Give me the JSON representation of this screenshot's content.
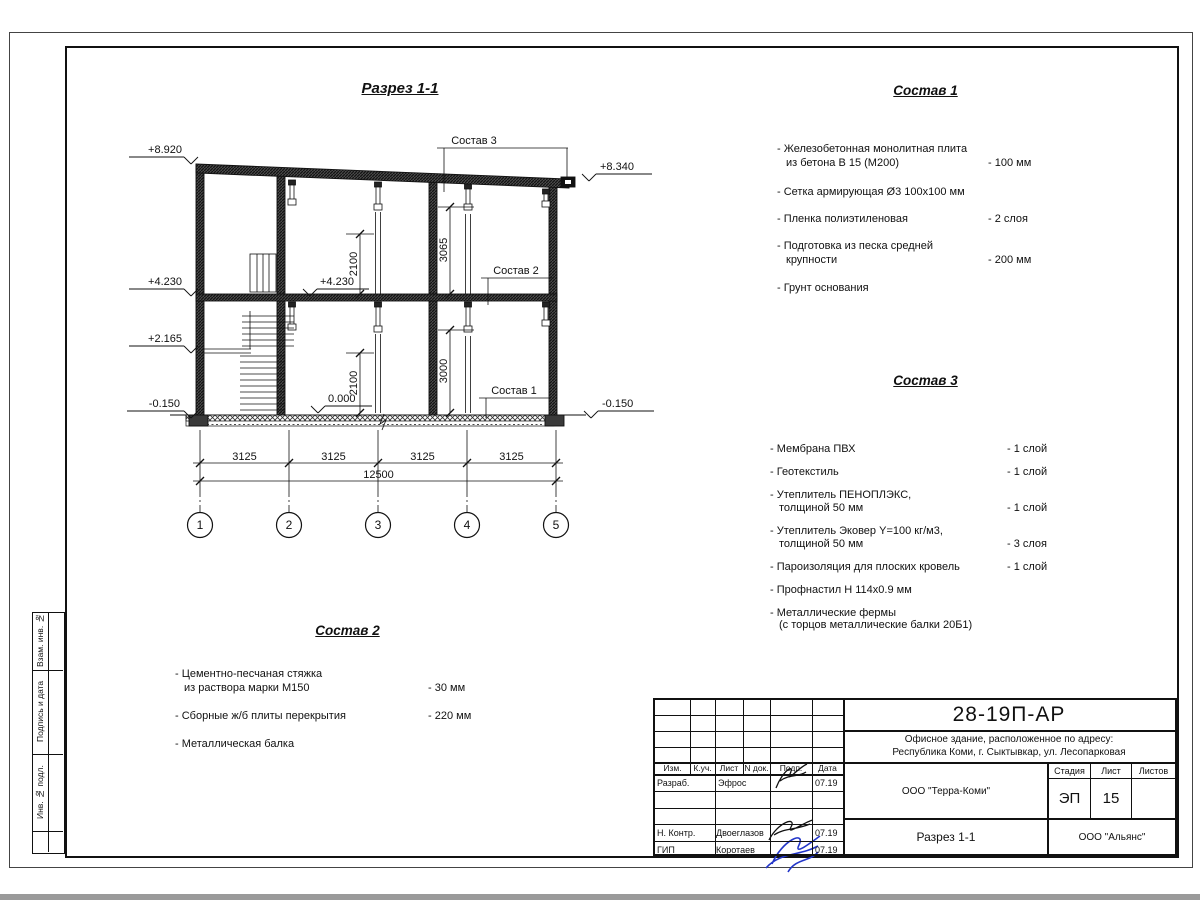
{
  "colors": {
    "line": "#111111",
    "signature_blue": "#2336c9"
  },
  "drawing": {
    "title": "Разрез 1-1",
    "grid_bubbles": [
      "1",
      "2",
      "3",
      "4",
      "5"
    ],
    "h_dims": [
      "3125",
      "3125",
      "3125",
      "3125"
    ],
    "h_dim_total": "12500",
    "v_dims": [
      "2100",
      "3065",
      "2100",
      "3000"
    ],
    "elevations": {
      "left": [
        "+8.920",
        "+4.230",
        "+2.165",
        "-0.150"
      ],
      "right_top": "+8.340",
      "right_bottom": "-0.150",
      "inner_level": "+4.230",
      "inner_zero": "0.000"
    }
  },
  "lists": {
    "sostav1": {
      "title": "Состав 1",
      "items": [
        {
          "line1": "- Железобетонная  монолитная плита",
          "line2": "из бетона В 15 (М200)",
          "value": "- 100 мм"
        },
        {
          "line1": "- Сетка армирующая Ø3 100х100 мм",
          "line2": "",
          "value": ""
        },
        {
          "line1": "- Пленка полиэтиленовая",
          "line2": "",
          "value": "-  2 слоя"
        },
        {
          "line1": "- Подготовка из песка средней",
          "line2": "крупности",
          "value": "- 200 мм"
        },
        {
          "line1": "- Грунт основания",
          "line2": "",
          "value": ""
        }
      ]
    },
    "sostav2": {
      "title": "Состав 2",
      "items": [
        {
          "line1": "- Цементно-песчаная стяжка",
          "line2": "из раствора марки М150",
          "value": "- 30 мм"
        },
        {
          "line1": "- Сборные ж/б плиты перекрытия",
          "line2": "",
          "value": "- 220 мм"
        },
        {
          "line1": "- Металлическая балка",
          "line2": "",
          "value": ""
        }
      ]
    },
    "sostav3": {
      "title": "Состав 3",
      "items": [
        {
          "line1": "- Мембрана ПВХ",
          "line2": "",
          "value": "- 1 слой"
        },
        {
          "line1": "- Геотекстиль",
          "line2": "",
          "value": "- 1 слой"
        },
        {
          "line1": "- Утеплитель ПЕНОПЛЭКС,",
          "line2": "толщиной 50 мм",
          "value": "- 1 слой"
        },
        {
          "line1": "- Утеплитель Эковер Y=100 кг/м3,",
          "line2": "толщиной 50 мм",
          "value": "- 3 слоя"
        },
        {
          "line1": "- Пароизоляция для плоских кровель",
          "line2": "",
          "value": "- 1 слой"
        },
        {
          "line1": "- Профнастил Н 114х0.9 мм",
          "line2": "",
          "value": ""
        },
        {
          "line1": "- Металлические фермы",
          "line2": "(с торцов металлические балки 20Б1)",
          "value": ""
        }
      ]
    }
  },
  "titleblock": {
    "doc_number": "28-19П-АР",
    "object_line1": "Офисное здание, расположенное по адресу:",
    "object_line2": "Республика Коми, г. Сыктывкар, ул. Лесопарковая",
    "col_izm": "Изм.",
    "col_kuch": "К.уч.",
    "col_list": "Лист",
    "col_ndok": "N док.",
    "col_podp": "Подп.",
    "col_data": "Дата",
    "razrab_label": "Разраб.",
    "razrab_name": "Эфрос",
    "razrab_date": "07.19",
    "nkontr_label": "Н. Контр.",
    "nkontr_name": "Двоеглазов",
    "nkontr_date": "07.19",
    "gip_label": "ГИП",
    "gip_name": "Коротаев",
    "gip_date": "07.19",
    "company": "ООО \"Терра-Коми\"",
    "stage_label": "Стадия",
    "sheet_label": "Лист",
    "sheets_label": "Листов",
    "stage": "ЭП",
    "sheet": "15",
    "sheets": "",
    "sheet_title": "Разрез 1-1",
    "contractor": "ООО \"Альянс\""
  },
  "side_strip": {
    "box1": "Взам. инв. №",
    "box2": "Подпись и дата",
    "box3": "Инв. № подл."
  }
}
